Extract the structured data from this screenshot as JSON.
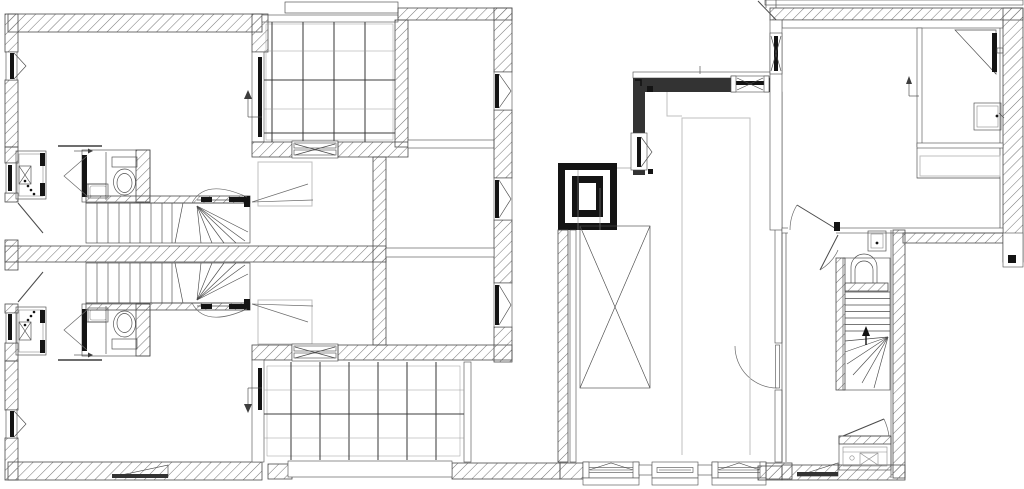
{
  "canvas": {
    "width": 1024,
    "height": 489,
    "viewBox": "0 0 1024 489"
  },
  "colors": {
    "bg": "#ffffff",
    "line": "#4a4a4a",
    "line-light": "#8a8a8a",
    "line-faint": "#bfbfbf",
    "dark": "#141414",
    "wall-dark": "#333333"
  },
  "drawing": {
    "type": "architectural floor plan, black-and-white CAD line drawing",
    "text_labels": [],
    "buildings": [
      "left dual dwelling (two mirrored units)",
      "central garage with ramp void and chimney flue",
      "right dwelling with shower room and winder stair"
    ]
  },
  "legend": {
    "symbols": [
      "hatched-wall",
      "tiled-terrace",
      "staircase-with-winders",
      "toilet",
      "wash-basin",
      "shower",
      "chimney-flue",
      "casement-window",
      "sliding-door",
      "door-swing",
      "direction-arrow",
      "crossed-void",
      "entry-ramp"
    ]
  },
  "fixtures": {
    "toilets": 3,
    "wash_basins": 5,
    "showers": 1,
    "staircases": 3,
    "tiled_terraces": 2,
    "chimneys": 1,
    "wardrobes": 2,
    "entry_ramps": 2
  }
}
